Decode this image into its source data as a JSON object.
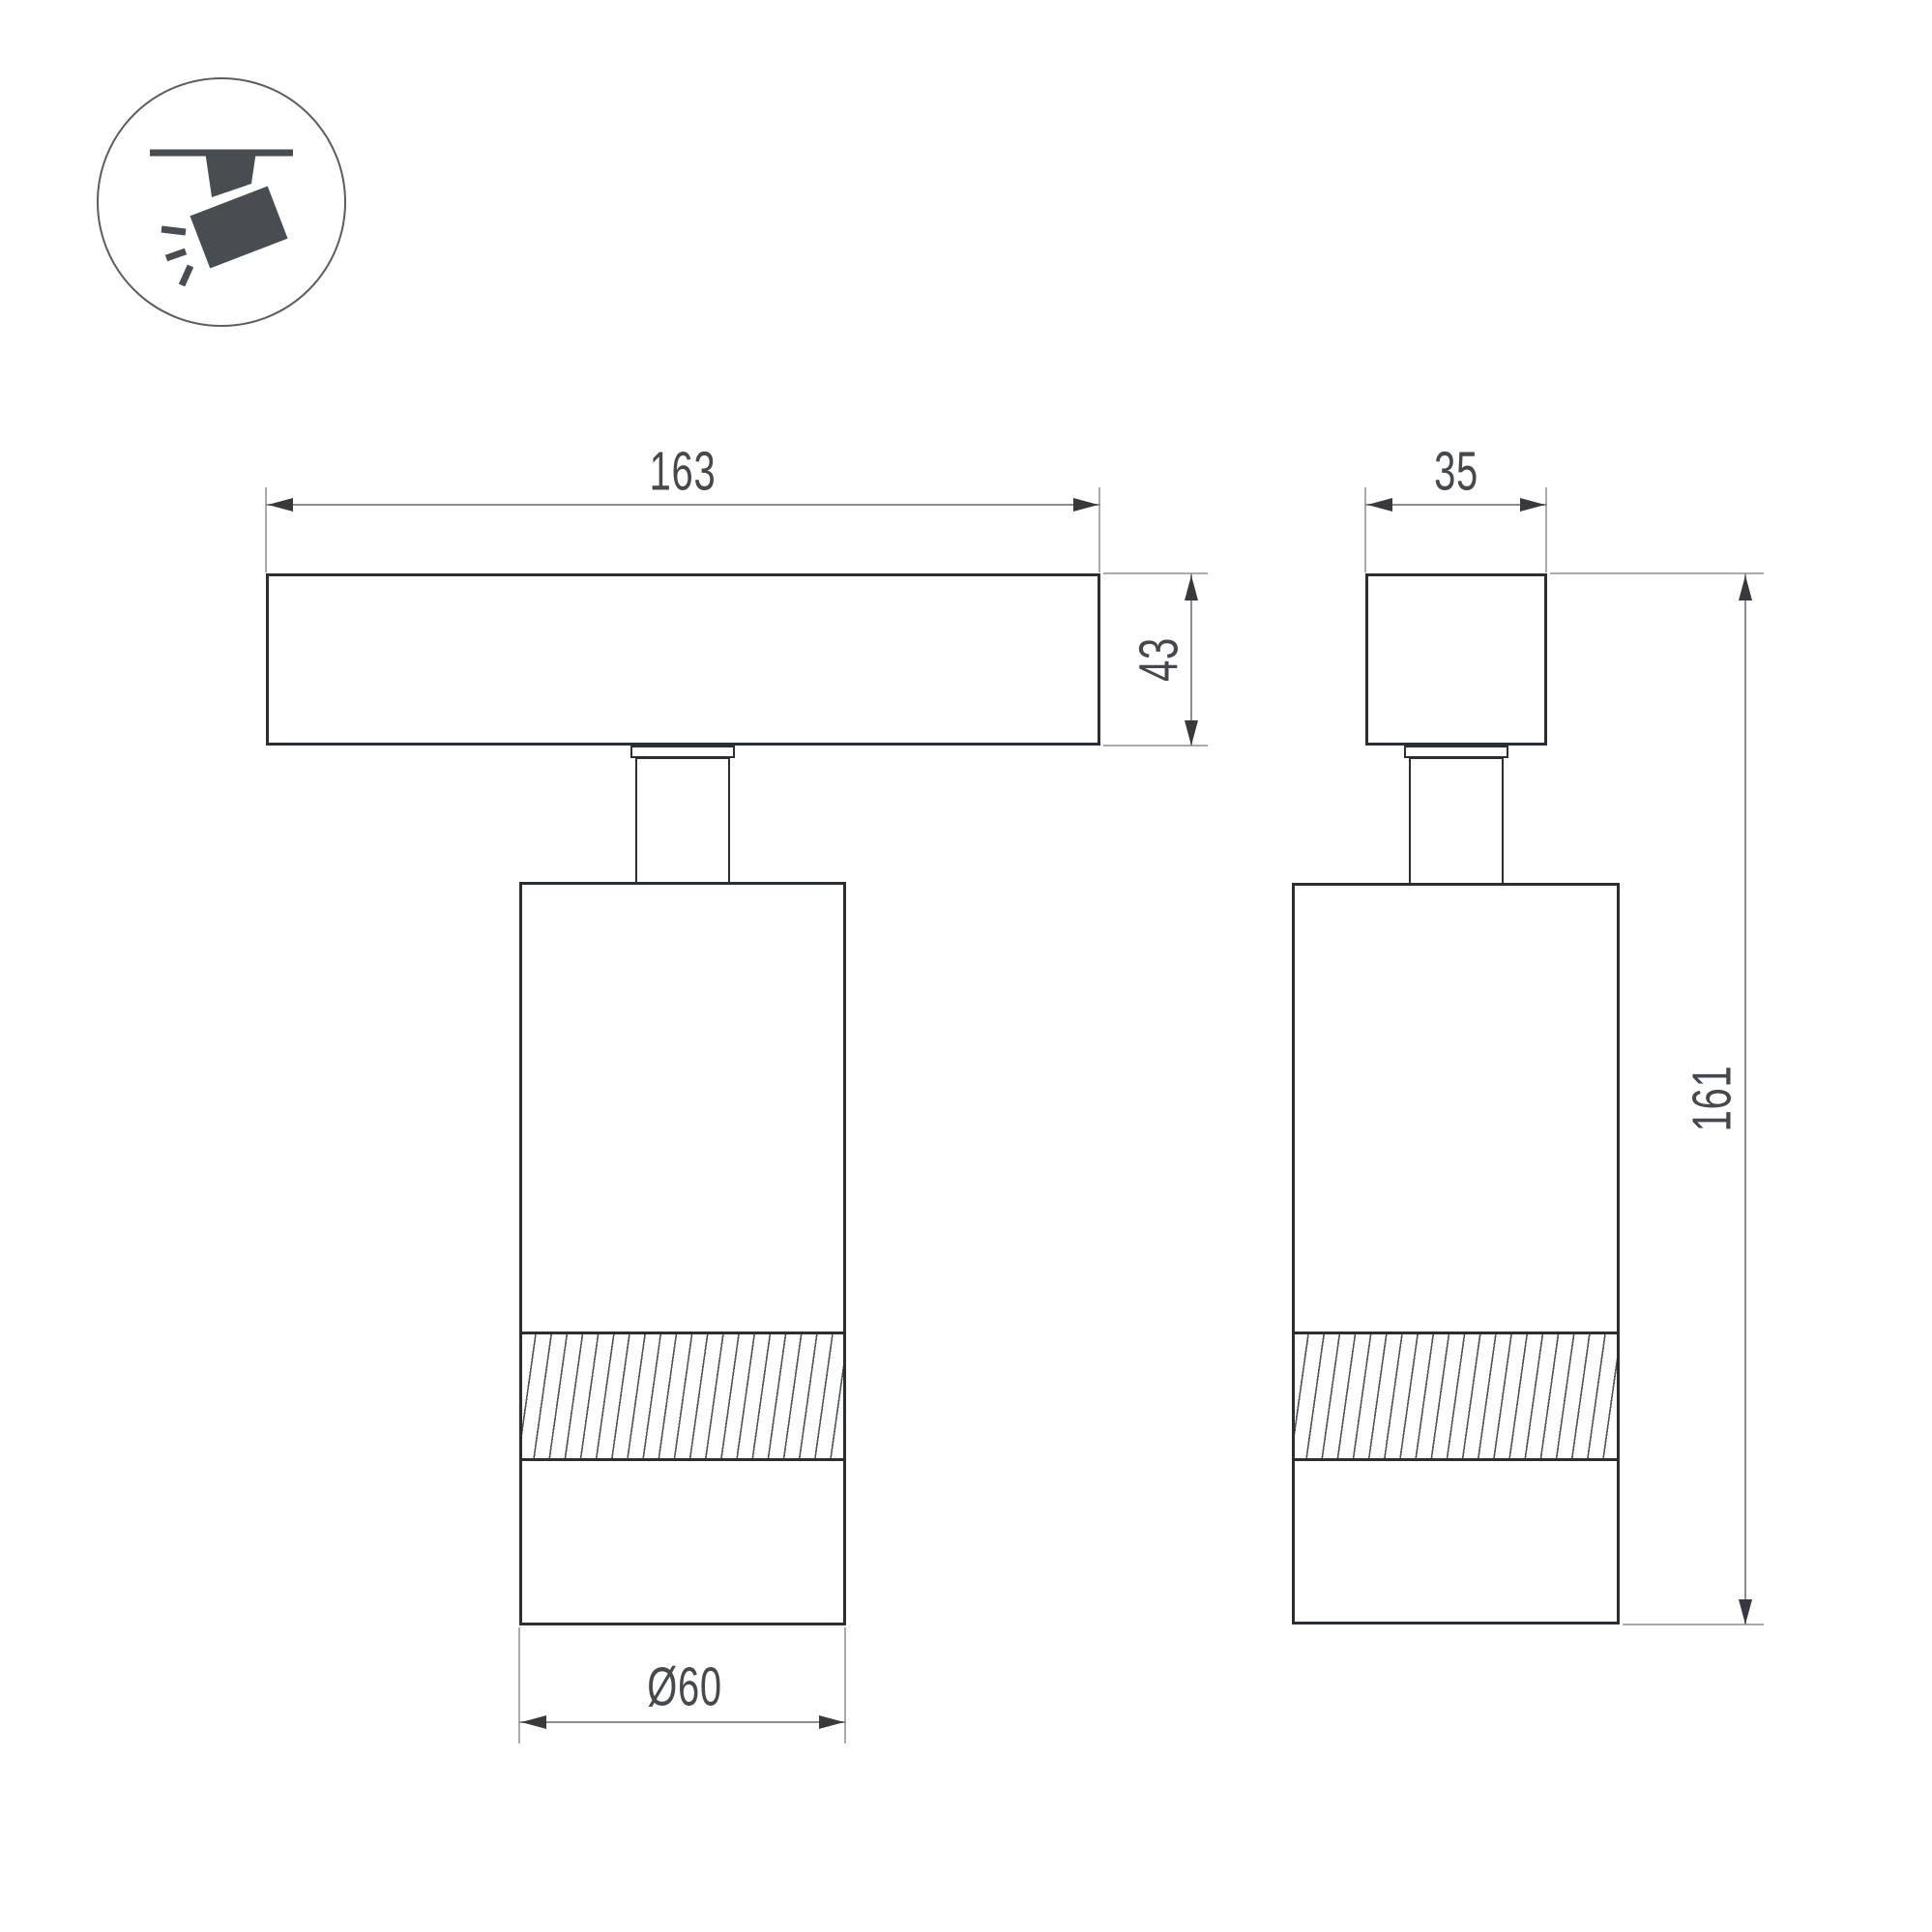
{
  "meta": {
    "title": "Track spotlight dimension drawing",
    "views": [
      "front view",
      "side view"
    ]
  },
  "icon": {
    "name": "ceiling-track-spotlight-icon"
  },
  "dimensions": {
    "track_length_mm": "163",
    "track_height_mm": "43",
    "track_width_mm": "35",
    "overall_height_mm": "161",
    "body_diameter_mm": "Ø60"
  },
  "colors": {
    "background": "#ffffff",
    "outline": "#2c2f32",
    "dimension_line": "#8b8e91",
    "extension_line": "#a8abad",
    "arrow": "#37393c",
    "label_text": "#45484c",
    "icon_fill": "#484d52"
  }
}
